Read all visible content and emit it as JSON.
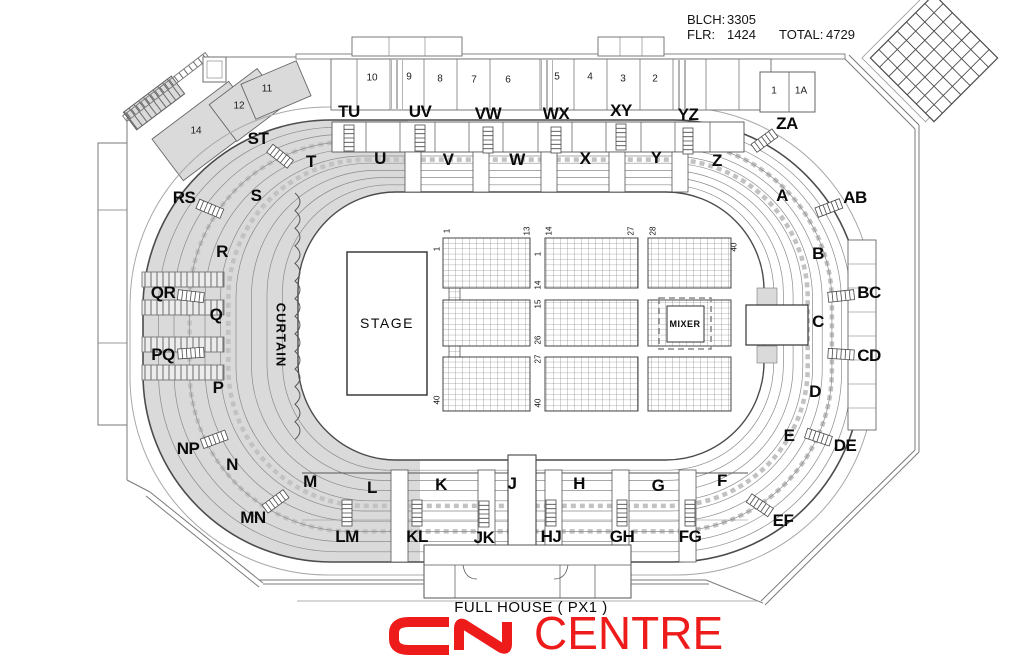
{
  "stats": {
    "blch_label": "BLCH:",
    "blch_value": "3305",
    "flr_label": "FLR:",
    "flr_value": "1424",
    "total_label": "TOTAL:",
    "total_value": "4729"
  },
  "floor_labels": {
    "stage": "STAGE",
    "mixer": "MIXER",
    "curtain": "CURTAIN"
  },
  "footer": {
    "config": "FULL HOUSE ( PX1 )",
    "logo_name": "CENTRE"
  },
  "colors": {
    "logo_red": "#ee1b1b",
    "shade": "#dadada"
  },
  "sections": [
    {
      "id": "TU",
      "x": 349,
      "y": 112,
      "aisle": true
    },
    {
      "id": "UV",
      "x": 420,
      "y": 112,
      "aisle": true
    },
    {
      "id": "VW",
      "x": 488,
      "y": 114,
      "aisle": true
    },
    {
      "id": "WX",
      "x": 556,
      "y": 114,
      "aisle": true
    },
    {
      "id": "XY",
      "x": 621,
      "y": 111,
      "aisle": true
    },
    {
      "id": "YZ",
      "x": 688,
      "y": 115,
      "aisle": true
    },
    {
      "id": "ZA",
      "x": 787,
      "y": 124,
      "aisle": true
    },
    {
      "id": "AB",
      "x": 855,
      "y": 198,
      "aisle": true
    },
    {
      "id": "BC",
      "x": 869,
      "y": 293,
      "aisle": true
    },
    {
      "id": "CD",
      "x": 869,
      "y": 356,
      "aisle": true
    },
    {
      "id": "DE",
      "x": 845,
      "y": 446,
      "aisle": true
    },
    {
      "id": "EF",
      "x": 783,
      "y": 521,
      "aisle": true
    },
    {
      "id": "FG",
      "x": 690,
      "y": 537,
      "aisle": true
    },
    {
      "id": "GH",
      "x": 622,
      "y": 537,
      "aisle": true
    },
    {
      "id": "HJ",
      "x": 551,
      "y": 537,
      "aisle": true
    },
    {
      "id": "JK",
      "x": 484,
      "y": 538,
      "aisle": true
    },
    {
      "id": "KL",
      "x": 417,
      "y": 537,
      "aisle": true
    },
    {
      "id": "LM",
      "x": 347,
      "y": 537,
      "aisle": true
    },
    {
      "id": "MN",
      "x": 253,
      "y": 518,
      "aisle": true
    },
    {
      "id": "NP",
      "x": 188,
      "y": 449,
      "aisle": true
    },
    {
      "id": "PQ",
      "x": 163,
      "y": 355,
      "aisle": true
    },
    {
      "id": "QR",
      "x": 163,
      "y": 293,
      "aisle": true
    },
    {
      "id": "RS",
      "x": 184,
      "y": 198,
      "aisle": true
    },
    {
      "id": "ST",
      "x": 258,
      "y": 139,
      "aisle": true
    },
    {
      "id": "T",
      "x": 311,
      "y": 162
    },
    {
      "id": "U",
      "x": 380,
      "y": 159
    },
    {
      "id": "V",
      "x": 448,
      "y": 160
    },
    {
      "id": "W",
      "x": 517,
      "y": 160
    },
    {
      "id": "X",
      "x": 585,
      "y": 159
    },
    {
      "id": "Y",
      "x": 656,
      "y": 158
    },
    {
      "id": "Z",
      "x": 717,
      "y": 161
    },
    {
      "id": "A",
      "x": 782,
      "y": 196
    },
    {
      "id": "B",
      "x": 818,
      "y": 254
    },
    {
      "id": "C",
      "x": 818,
      "y": 322
    },
    {
      "id": "D",
      "x": 815,
      "y": 392
    },
    {
      "id": "E",
      "x": 789,
      "y": 436
    },
    {
      "id": "F",
      "x": 722,
      "y": 481
    },
    {
      "id": "G",
      "x": 658,
      "y": 486
    },
    {
      "id": "H",
      "x": 579,
      "y": 484
    },
    {
      "id": "J",
      "x": 512,
      "y": 484
    },
    {
      "id": "K",
      "x": 441,
      "y": 485
    },
    {
      "id": "L",
      "x": 372,
      "y": 488
    },
    {
      "id": "M",
      "x": 310,
      "y": 482
    },
    {
      "id": "N",
      "x": 232,
      "y": 465
    },
    {
      "id": "P",
      "x": 218,
      "y": 388
    },
    {
      "id": "Q",
      "x": 216,
      "y": 315
    },
    {
      "id": "R",
      "x": 222,
      "y": 252
    },
    {
      "id": "S",
      "x": 256,
      "y": 196
    }
  ],
  "rooms": [
    {
      "id": "14",
      "x": 196,
      "y": 131
    },
    {
      "id": "12",
      "x": 239,
      "y": 106
    },
    {
      "id": "11",
      "x": 267,
      "y": 89
    },
    {
      "id": "10",
      "x": 372,
      "y": 78
    },
    {
      "id": "9",
      "x": 409,
      "y": 77
    },
    {
      "id": "8",
      "x": 440,
      "y": 79
    },
    {
      "id": "7",
      "x": 474,
      "y": 80
    },
    {
      "id": "6",
      "x": 508,
      "y": 80
    },
    {
      "id": "5",
      "x": 557,
      "y": 77
    },
    {
      "id": "4",
      "x": 590,
      "y": 77
    },
    {
      "id": "3",
      "x": 623,
      "y": 79
    },
    {
      "id": "2",
      "x": 655,
      "y": 79
    },
    {
      "id": "1",
      "x": 774,
      "y": 91
    },
    {
      "id": "1A",
      "x": 801,
      "y": 91
    }
  ],
  "floor_rows": [
    {
      "n": "1",
      "x": 447,
      "y": 231
    },
    {
      "n": "13",
      "x": 527,
      "y": 231
    },
    {
      "n": "14",
      "x": 549,
      "y": 231
    },
    {
      "n": "27",
      "x": 631,
      "y": 231
    },
    {
      "n": "28",
      "x": 653,
      "y": 231
    },
    {
      "n": "40",
      "x": 734,
      "y": 247
    },
    {
      "n": "1",
      "x": 437,
      "y": 249
    },
    {
      "n": "40",
      "x": 437,
      "y": 400
    },
    {
      "n": "1",
      "x": 538,
      "y": 254
    },
    {
      "n": "14",
      "x": 538,
      "y": 285
    },
    {
      "n": "15",
      "x": 538,
      "y": 304
    },
    {
      "n": "26",
      "x": 538,
      "y": 340
    },
    {
      "n": "27",
      "x": 538,
      "y": 359
    },
    {
      "n": "40",
      "x": 538,
      "y": 403
    }
  ]
}
